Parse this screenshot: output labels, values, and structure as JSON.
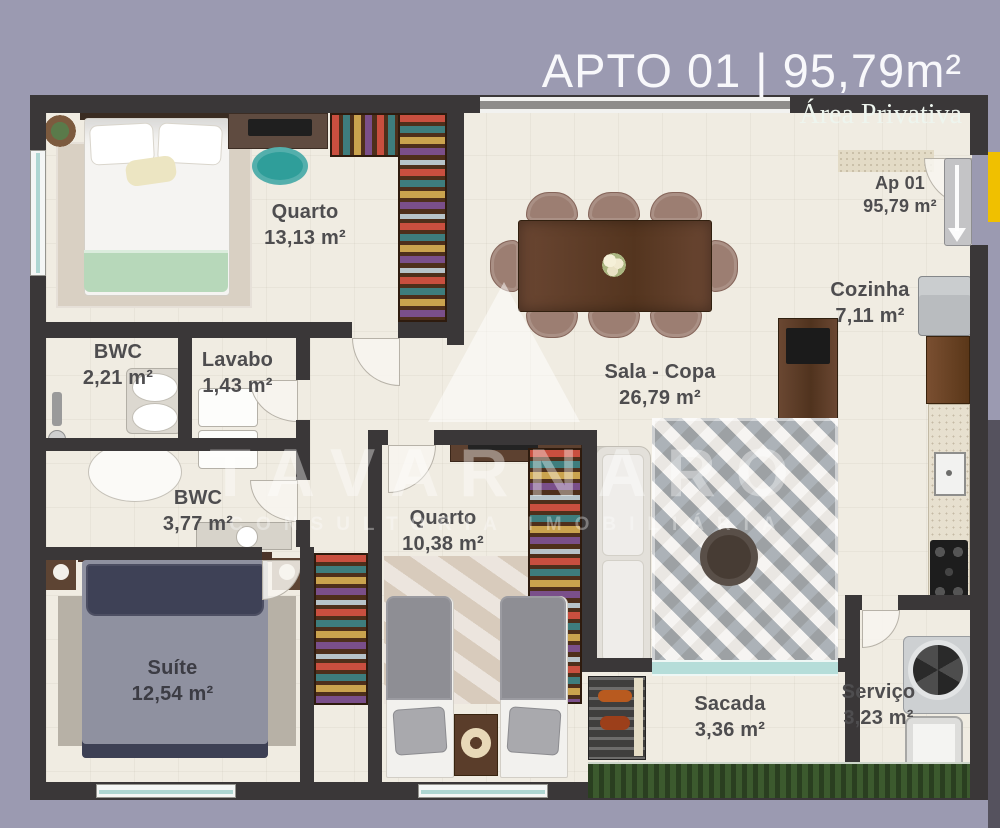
{
  "header": {
    "title": "APTO 01 | 95,79m²",
    "subtitle": "Área Privativa"
  },
  "unit_label": {
    "name": "Ap 01",
    "area": "95,79 m²"
  },
  "rooms": {
    "quarto_casal": {
      "name": "Quarto",
      "area": "13,13 m²"
    },
    "cozinha": {
      "name": "Cozinha",
      "area": "7,11 m²"
    },
    "bwc_suite": {
      "name": "BWC",
      "area": "2,21 m²"
    },
    "lavabo": {
      "name": "Lavabo",
      "area": "1,43 m²"
    },
    "sala_copa": {
      "name": "Sala - Copa",
      "area": "26,79 m²"
    },
    "bwc_social": {
      "name": "BWC",
      "area": "3,77 m²"
    },
    "quarto_solteiro": {
      "name": "Quarto",
      "area": "10,38 m²"
    },
    "suite": {
      "name": "Suíte",
      "area": "12,54 m²"
    },
    "sacada": {
      "name": "Sacada",
      "area": "3,36 m²"
    },
    "servico": {
      "name": "Serviço",
      "area": "3,23 m²"
    }
  },
  "watermark": {
    "brand": "TAVARNARO",
    "tagline": "CONSULTORIA IMOBILIÁRIA"
  },
  "colors": {
    "background": "#9b9ab1",
    "wall": "#3a3738",
    "floor": "#f0ece2",
    "wood_dark": "#5a3b28",
    "accent_yellow": "#f0c000",
    "glass_teal": "#aed6d2",
    "grass_green": "#3c5a2e",
    "bed_green": "#b7d8ba",
    "suite_navy": "#3e4156",
    "chair_teal": "#2f9e9a"
  }
}
